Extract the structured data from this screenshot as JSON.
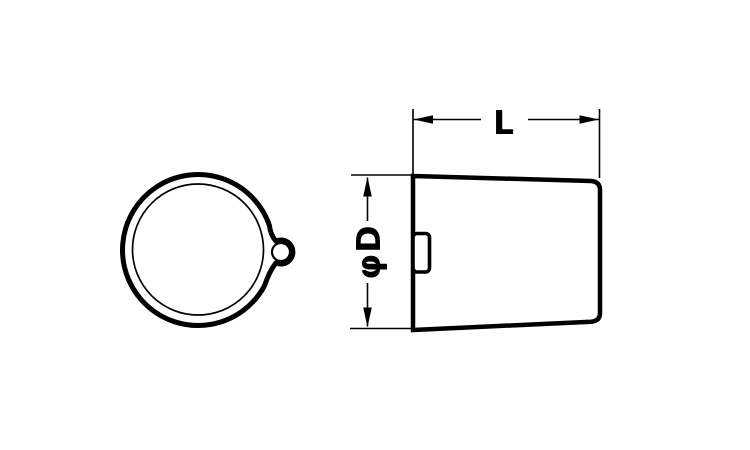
{
  "colors": {
    "background": "#ffffff",
    "line": "#000000"
  },
  "dimension_labels": {
    "length": "L",
    "diameter": "φD"
  }
}
